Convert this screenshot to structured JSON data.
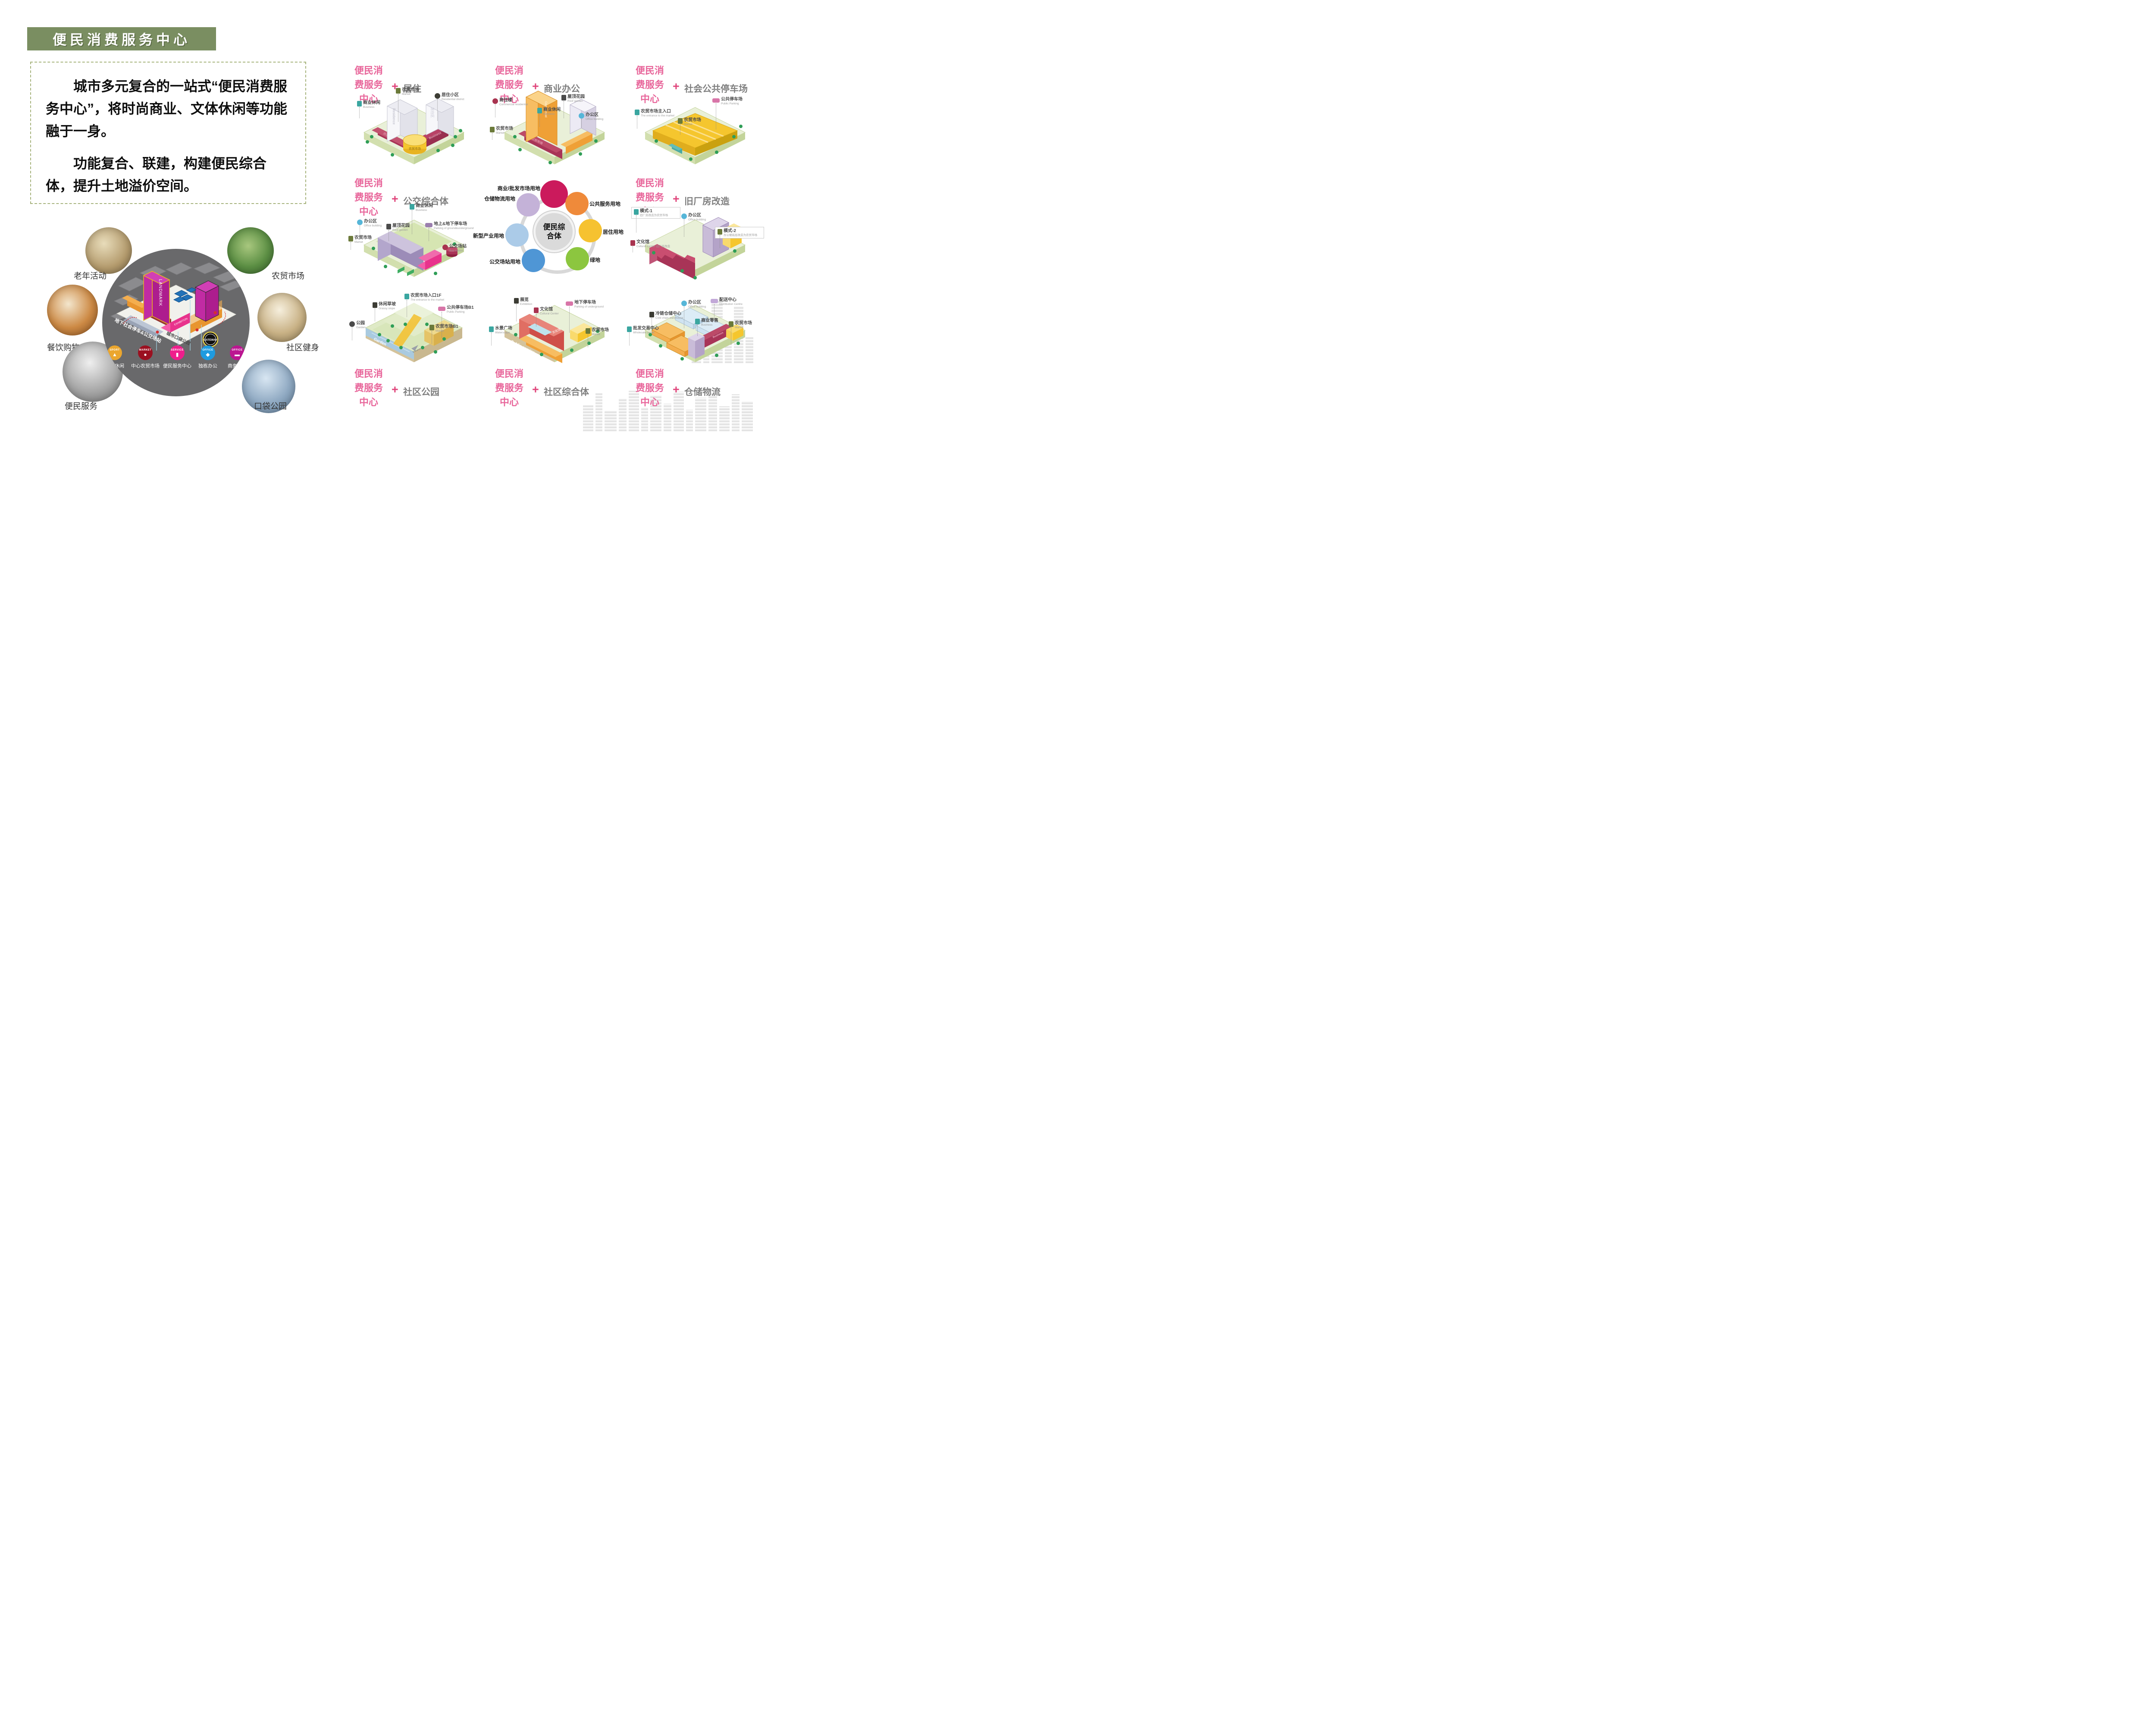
{
  "slide_title": "便民消费服务中心",
  "intro": {
    "paragraph1": "城市多元复合的一站式“便民消费服务中心”，将时尚商业、文体休闲等功能融于一身。",
    "paragraph2": "功能复合、联建，构建便民综合体，提升土地溢价空间。"
  },
  "colors": {
    "banner_green": "#7a8e61",
    "accent_pink": "#e8659a",
    "function_gray": "#7f7f7f"
  },
  "cluster": {
    "photos": [
      {
        "label": "老年活动"
      },
      {
        "label": "农贸市场"
      },
      {
        "label": "餐饮购物"
      },
      {
        "label": "社区健身"
      },
      {
        "label": "便民服务"
      },
      {
        "label": "口袋公园"
      }
    ],
    "model": {
      "landmark": "LANDMARK",
      "exhibition": "EXHIBITION",
      "gateway": "GATEWAY",
      "parking_note": "地下社会停车&公交场站",
      "park_note": "城市口袋公园",
      "legend": [
        {
          "tag": "SPORT",
          "label": "文体休闲",
          "color": "#eba62e"
        },
        {
          "tag": "MARKET",
          "label": "中心农贸市场",
          "color": "#9b1020"
        },
        {
          "tag": "SERVICE",
          "label": "便民服务中心",
          "color": "#ef1e8c"
        },
        {
          "tag": "OFFICE",
          "label": "独栋办公",
          "color": "#1e9be0"
        },
        {
          "tag": "OFFICE",
          "label": "商务商住",
          "color": "#bb1691"
        }
      ]
    }
  },
  "grid": {
    "label_lines": [
      "便民消",
      "费服务",
      "中心"
    ],
    "plus": "+",
    "cells": [
      {
        "function": "居住",
        "marks": [
          "Residence",
          "居住区",
          "Business",
          "商业",
          "农贸市场"
        ],
        "callouts": [
          {
            "cn": "商业休闲",
            "en": "Business"
          },
          {
            "cn": "农贸市场",
            "en": "Market"
          },
          {
            "cn": "居住小区",
            "en": "Residential district"
          }
        ]
      },
      {
        "function": "商业办公",
        "marks": [
          "Commercial",
          "农贸市场"
        ],
        "callouts": [
          {
            "cn": "商住楼",
            "en": "Commercial residential"
          },
          {
            "cn": "屋顶花园",
            "en": "Roof garden"
          },
          {
            "cn": "商业休闲",
            "en": "Business"
          },
          {
            "cn": "办公区",
            "en": "Office building"
          },
          {
            "cn": "农贸市场",
            "en": "Market"
          }
        ]
      },
      {
        "function": "社会公共停车场",
        "marks": [],
        "callouts": [
          {
            "cn": "农贸市场主入口",
            "en": "The entrance to the market"
          },
          {
            "cn": "农贸市场",
            "en": "Market"
          },
          {
            "cn": "公共停车场",
            "en": "Public Parking"
          }
        ]
      },
      {
        "function": "公交综合体",
        "marks": [],
        "callouts": [
          {
            "cn": "办公区",
            "en": "Office building"
          },
          {
            "cn": "农贸市场",
            "en": "Market"
          },
          {
            "cn": "屋顶花园",
            "en": "Roof garden"
          },
          {
            "cn": "商业休闲",
            "en": "Business"
          },
          {
            "cn": "地上&地下停车场",
            "en": "Parking of ground&underground"
          },
          {
            "cn": "公交场站",
            "en": "Bus station"
          }
        ]
      },
      {
        "function": "旧厂房改造",
        "marks": [],
        "callouts": [
          {
            "cn": "模式-1",
            "en": "旧厂房改造为农贸市场"
          },
          {
            "cn": "办公区",
            "en": "Office building"
          },
          {
            "cn": "文化馆",
            "en": "Cultural Center 旧厂房改造"
          },
          {
            "cn": "模式-2",
            "en": "办公楼底层改造为农贸市场"
          }
        ]
      },
      {
        "function": "社区公园",
        "marks": [
          "Garden",
          "Market>>",
          "Parking>>",
          "Entrance"
        ],
        "callouts": [
          {
            "cn": "公园",
            "en": "Garden"
          },
          {
            "cn": "休闲草坡",
            "en": "Grassy slope"
          },
          {
            "cn": "农贸市场入口1F",
            "en": "The entrance to the market"
          },
          {
            "cn": "公共停车场B1",
            "en": "Public Parking"
          },
          {
            "cn": "农贸市场B1",
            "en": "Market"
          }
        ]
      },
      {
        "function": "社区综合体",
        "marks": [
          "Public service",
          "文化馆"
        ],
        "callouts": [
          {
            "cn": "水景广场",
            "en": "Waterscape"
          },
          {
            "cn": "展览",
            "en": "Exhibition"
          },
          {
            "cn": "文化馆",
            "en": "Cultural Center"
          },
          {
            "cn": "地下停车场",
            "en": "Parking of underground"
          },
          {
            "cn": "农贸市场",
            "en": "Market"
          }
        ]
      },
      {
        "function": "仓储物流",
        "marks": [
          "Business"
        ],
        "callouts": [
          {
            "cn": "批发交易中心",
            "en": "Wholesale center"
          },
          {
            "cn": "冷链仓储中心",
            "en": "Cold chain warehouse"
          },
          {
            "cn": "办公区",
            "en": "Office building"
          },
          {
            "cn": "商业零售",
            "en": "Business"
          },
          {
            "cn": "配送中心",
            "en": "Distribution Centre"
          },
          {
            "cn": "农贸市场",
            "en": "Market"
          }
        ]
      }
    ],
    "hub": {
      "center": "便民综合体",
      "bubbles": [
        {
          "label": "商业/批发市场用地",
          "color": "#cb1a5c"
        },
        {
          "label": "公共服务用地",
          "color": "#ef8a3a"
        },
        {
          "label": "居住用地",
          "color": "#f6c230"
        },
        {
          "label": "绿地",
          "color": "#8cc63f"
        },
        {
          "label": "公交场站用地",
          "color": "#4f96d5"
        },
        {
          "label": "新型产业用地",
          "color": "#abcbe8"
        },
        {
          "label": "仓储物流用地",
          "color": "#c4b2d8"
        }
      ]
    }
  }
}
